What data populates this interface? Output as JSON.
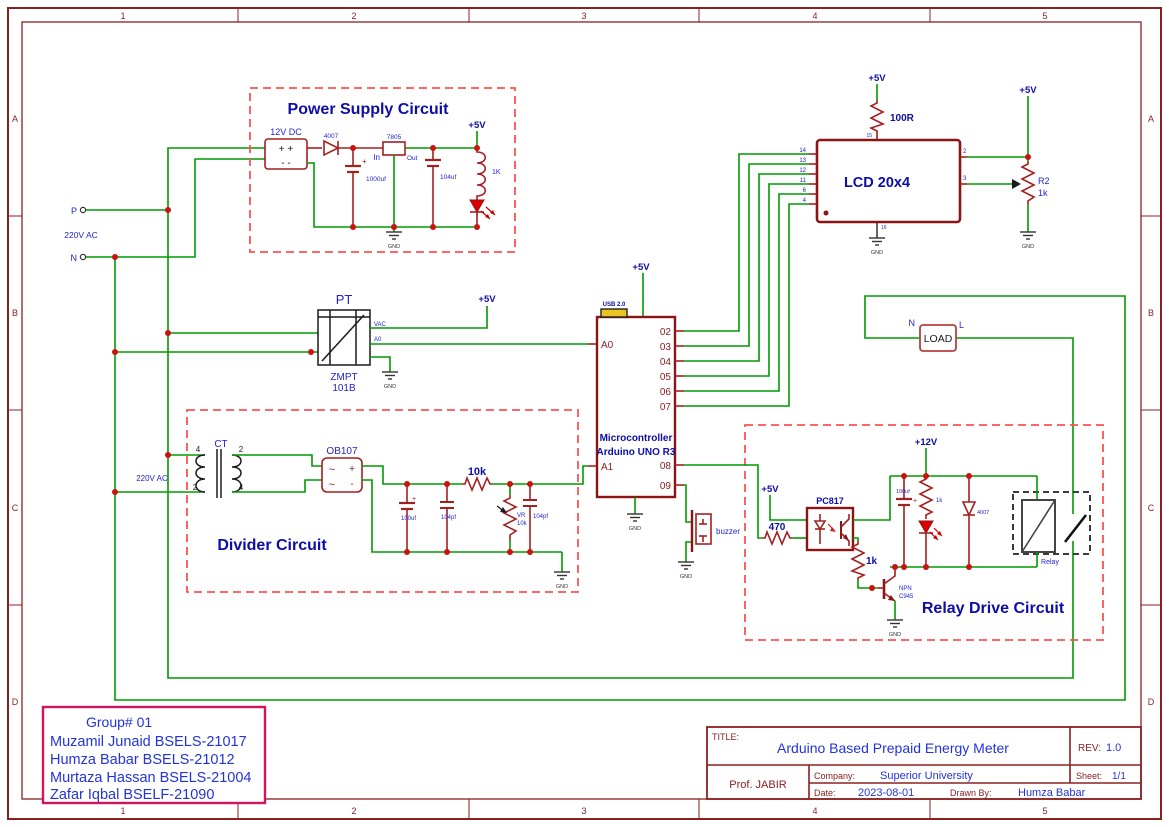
{
  "sheet": {
    "cols": [
      "1",
      "2",
      "3",
      "4",
      "5"
    ],
    "rows": [
      "A",
      "B",
      "C",
      "D"
    ]
  },
  "nets": {
    "v5": "+5V",
    "v12": "+12V",
    "gnd": "GND"
  },
  "sym": {
    "plus": "+",
    "minus": "-",
    "tilde": "~",
    "plus2": "+  +",
    "minus2": "-  -"
  },
  "source": {
    "p": "P",
    "n": "N",
    "voltage": "220V AC"
  },
  "power_supply": {
    "title": "Power Supply Circuit",
    "block_label": "12V DC",
    "diode": "4007",
    "cap1": "1000uf",
    "reg": "7805",
    "in": "In",
    "out": "Out",
    "cap2": "104uf",
    "res": "1K"
  },
  "pt": {
    "title": "PT",
    "name1": "ZMPT",
    "name2": "101B",
    "pin_vac": "VAC",
    "pin_a0": "A0"
  },
  "divider": {
    "title": "Divider Circuit",
    "voltage": "220V AC",
    "ct": "CT",
    "ct_pins": [
      "4",
      "2",
      "2",
      "4"
    ],
    "bridge": "OB107",
    "cap1": "100uf",
    "cap2": "104pf",
    "res": "10k",
    "vr_name": "VR",
    "vr_val": "10k",
    "cap3": "104pf"
  },
  "arduino": {
    "line1": "Microcontroller",
    "line2": "Arduino UNO R3",
    "usb": "USB 2.0",
    "pin_a0": "A0",
    "pin_a1": "A1",
    "digital": [
      "02",
      "03",
      "04",
      "05",
      "06",
      "07"
    ],
    "pin08": "08",
    "pin09": "09",
    "buzzer": "buzzer"
  },
  "lcd": {
    "title": "LCD 20x4",
    "left_pins": [
      "14",
      "13",
      "12",
      "11",
      "6",
      "4"
    ],
    "pin2": "2",
    "pin3": "3",
    "pin_top": "15",
    "pin_bot": "16",
    "res": "100R",
    "pot_name": "R2",
    "pot_val": "1k"
  },
  "load": {
    "label": "LOAD",
    "n": "N",
    "l": "L"
  },
  "relay": {
    "title": "Relay Drive Circuit",
    "opto": "PC817",
    "r_in": "470",
    "r_base": "1k",
    "npn1": "NPN",
    "npn2": "C945",
    "cap": "100uf",
    "r_led": "1k",
    "diode": "4007",
    "name": "Relay"
  },
  "group_box": {
    "title": "Group# 01",
    "members": [
      "Muzamil Junaid BSELS-21017",
      "Humza Babar BSELS-21012",
      "Murtaza Hassan BSELS-21004",
      "Zafar Iqbal BSELF-21090"
    ]
  },
  "title_block": {
    "title_label": "TITLE:",
    "title": "Arduino Based Prepaid Energy Meter",
    "rev_label": "REV:",
    "rev": "1.0",
    "author": "Prof. JABIR",
    "company_label": "Company:",
    "company": "Superior University",
    "sheet_label": "Sheet:",
    "sheet": "1/1",
    "date_label": "Date:",
    "date": "2023-08-01",
    "drawn_label": "Drawn By:",
    "drawn": "Humza Babar"
  }
}
